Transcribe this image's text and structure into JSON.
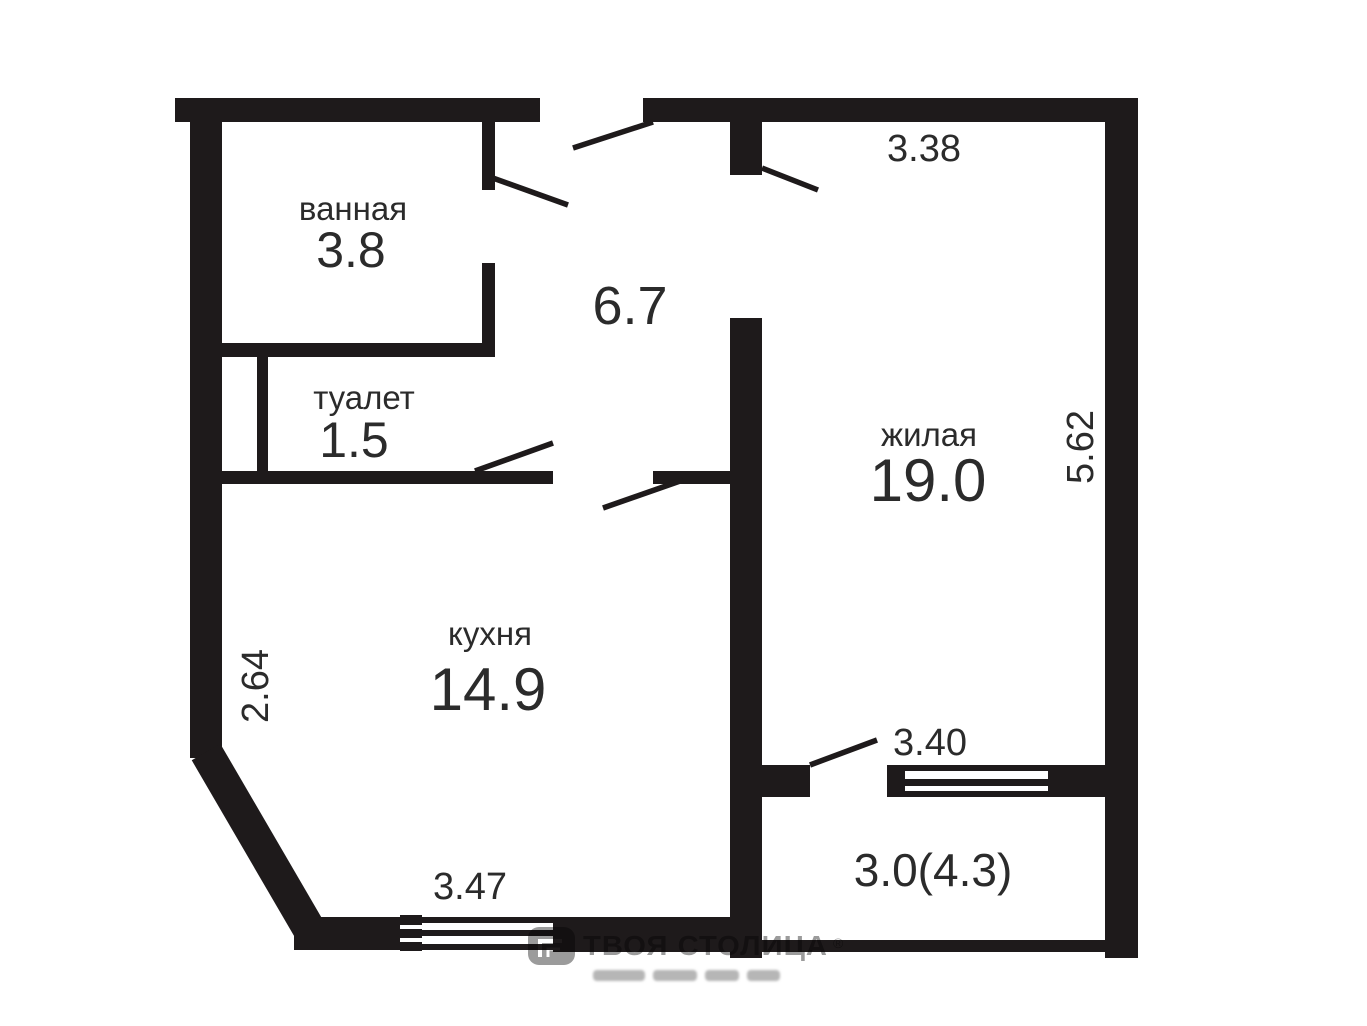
{
  "plan": {
    "wall_color": "#1e1a1b",
    "text_color": "#2b2b2b",
    "background": "#ffffff"
  },
  "rooms": [
    {
      "id": "bathroom",
      "name": "ванная",
      "area": "3.8"
    },
    {
      "id": "toilet",
      "name": "туалет",
      "area": "1.5"
    },
    {
      "id": "hallway",
      "name": "",
      "area": "6.7"
    },
    {
      "id": "living",
      "name": "жилая",
      "area": "19.0"
    },
    {
      "id": "kitchen",
      "name": "кухня",
      "area": "14.9"
    },
    {
      "id": "balcony",
      "name": "",
      "area": "3.0(4.3)"
    }
  ],
  "dimensions": [
    {
      "id": "living-top-width",
      "value": "3.38"
    },
    {
      "id": "living-right-height",
      "value": "5.62"
    },
    {
      "id": "kitchen-left-height",
      "value": "2.64"
    },
    {
      "id": "kitchen-bottom-width",
      "value": "3.47"
    },
    {
      "id": "balcony-width",
      "value": "3.40"
    }
  ],
  "watermark": {
    "brand": "ТВОЯ СТОЛИЦА",
    "registered": "®"
  }
}
